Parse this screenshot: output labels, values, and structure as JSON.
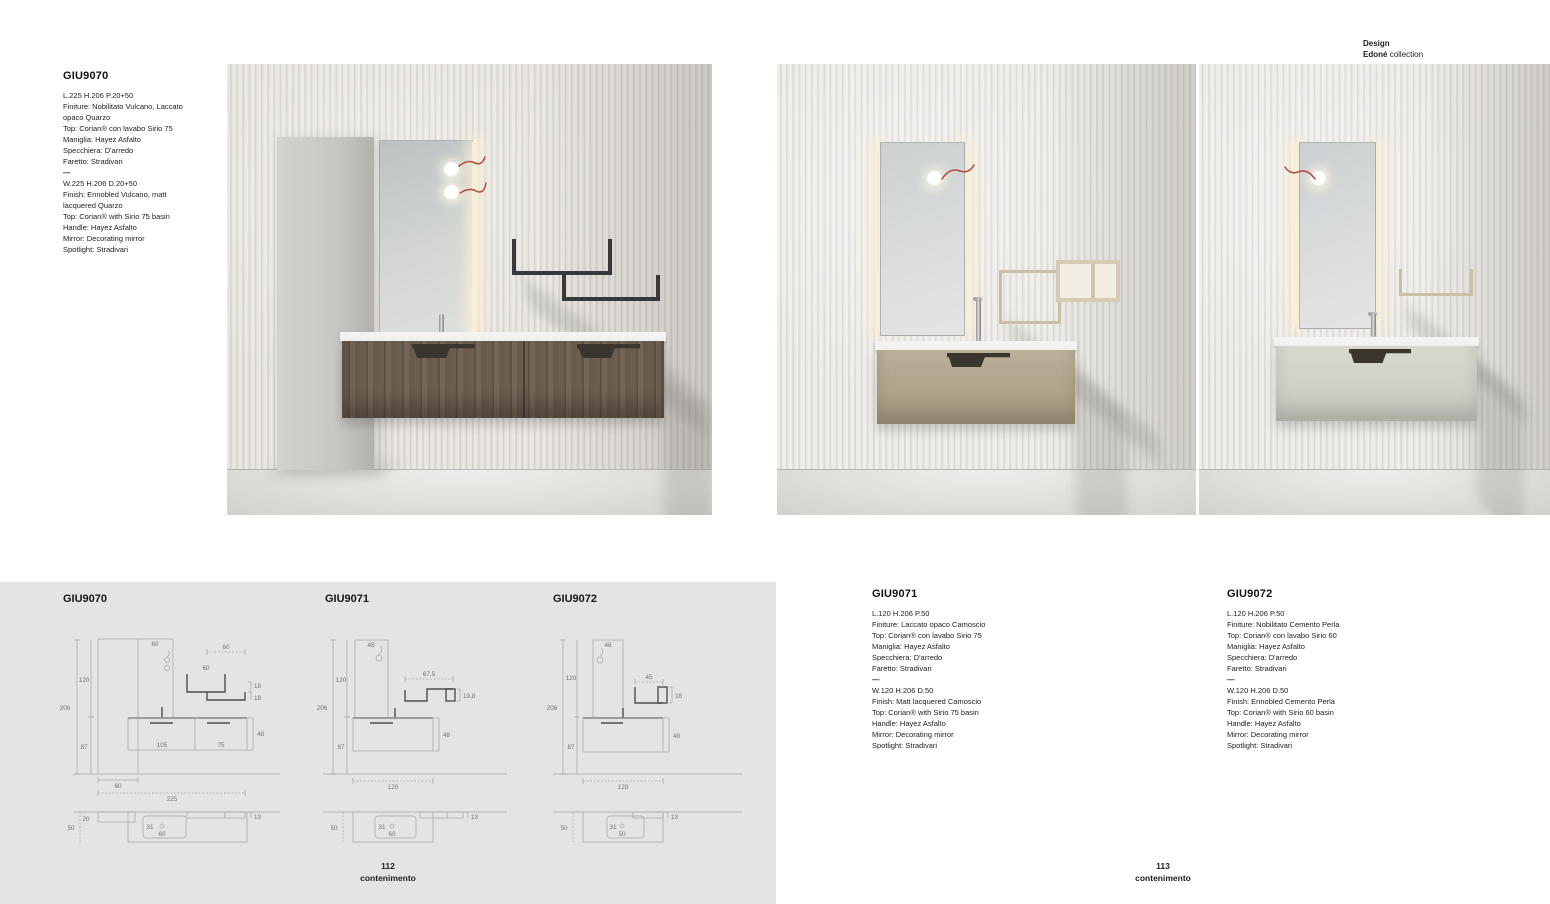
{
  "header": {
    "design": "Design",
    "collection_name": "Edoné",
    "collection_suffix": "collection"
  },
  "products": {
    "giu9070": {
      "code": "GIU9070",
      "it": [
        "L.225 H.206 P.20+50",
        "Finiture: Nobilitato Vulcano, Laccato opaco Quarzo",
        "Top: Corian® con lavabo Sirio 75",
        "Maniglia: Hayez Asfalto",
        "Specchiera: D'arredo",
        "Faretto: Stradivari"
      ],
      "sep": "—",
      "en": [
        "W.225 H.206 D.20+50",
        "Finish: Ennobled Vulcano, matt lacquered Quarzo",
        "Top: Corian® with Sirio 75 basin",
        "Handle: Hayez Asfalto",
        "Mirror: Decorating mirror",
        "Spotlight: Stradivari"
      ]
    },
    "giu9071": {
      "code": "GIU9071",
      "it": [
        "L.120 H.206 P.50",
        "Finiture: Laccato opaco Camoscio",
        "Top: Corian® con lavabo Sirio 75",
        "Maniglia: Hayez Asfalto",
        "Specchiera: D'arredo",
        "Faretto: Stradivari"
      ],
      "sep": "—",
      "en": [
        "W.120 H.206 D.50",
        "Finish: Matt lacquered Camoscio",
        "Top: Corian® with Sirio 75 basin",
        "Handle: Hayez Asfalto",
        "Mirror: Decorating mirror",
        "Spotlight: Stradivari"
      ]
    },
    "giu9072": {
      "code": "GIU9072",
      "it": [
        "L.120 H.206 P.50",
        "Finiture: Nobilitato Cemento Perla",
        "Top: Corian® con lavabo Sirio 60",
        "Maniglia: Hayez Asfalto",
        "Specchiera: D'arredo",
        "Faretto: Stradivari"
      ],
      "sep": "—",
      "en": [
        "W.120 H.206 D.50",
        "Finish: Ennobled Cemento Perla",
        "Top: Corian® with Sirio 60 basin",
        "Handle: Hayez Asfalto",
        "Mirror: Decorating mirror",
        "Spotlight: Stradivari"
      ]
    }
  },
  "drawings": {
    "d70": {
      "title": "GIU9070",
      "total_h": "206",
      "upper_h": "120",
      "lower_h": "87",
      "panel_w": "60",
      "shelf_top_w": "60",
      "shelf_w": "60",
      "shelf_h1": "18",
      "shelf_h2": "18",
      "vanity_w1": "105",
      "vanity_w2": "75",
      "vanity_h": "48",
      "col_w": "60",
      "total_w": "225",
      "plan_col_d": "20",
      "plan_d": "50",
      "basin_off": "31",
      "basin_dia": "60",
      "shelf_d": "13"
    },
    "d71": {
      "title": "GIU9071",
      "total_h": "206",
      "upper_h": "120",
      "lower_h": "87",
      "panel_w": "48",
      "shelf_w": "67,5",
      "shelf_h": "19,8",
      "vanity_h": "48",
      "total_w": "120",
      "plan_d": "50",
      "basin_off": "31",
      "basin_dia": "60",
      "shelf_d": "13"
    },
    "d72": {
      "title": "GIU9072",
      "total_h": "206",
      "upper_h": "120",
      "lower_h": "87",
      "panel_w": "48",
      "shelf_w": "45",
      "shelf_h": "18",
      "vanity_h": "48",
      "total_w": "120",
      "plan_d": "50",
      "basin_off": "31",
      "basin_dia": "50",
      "shelf_d": "13"
    }
  },
  "footers": {
    "left_page": "112",
    "left_label": "contenimento",
    "right_page": "113",
    "right_label": "contenimento"
  },
  "colors": {
    "panel_bg": "#e2e4e5",
    "wood": "#675a4e",
    "camoscio": "#b0a48b",
    "cemento_perla": "#d1d0c8",
    "accent_cord": "#b24a3e"
  }
}
